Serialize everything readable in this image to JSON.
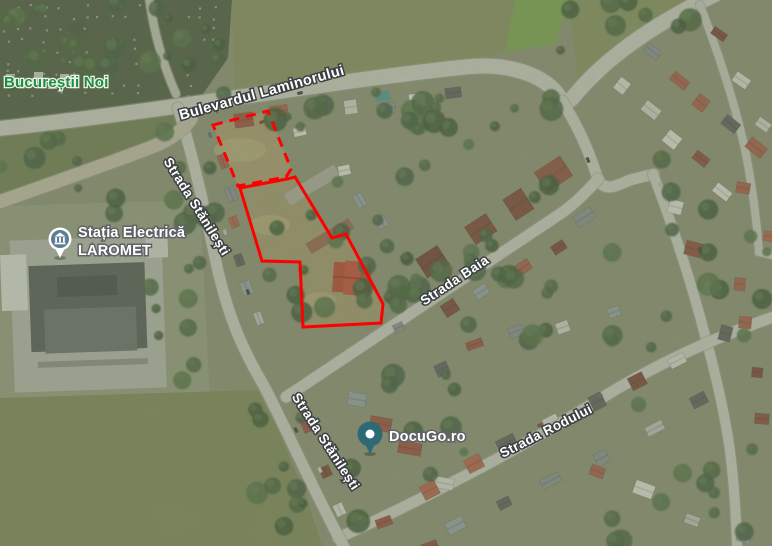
{
  "map": {
    "view_type": "satellite",
    "district_label": {
      "text": "Bucureștii Noi",
      "color": "#1e8e3e"
    },
    "street_labels": [
      {
        "text": "Bulevardul Laminorului",
        "rotation": -15.5
      },
      {
        "text": "Strada Stănilești",
        "rotation": 58
      },
      {
        "text": "Strada Stănilești",
        "rotation": 57
      },
      {
        "text": "Strada Baia",
        "rotation": -33.5
      },
      {
        "text": "Strada Rodului",
        "rotation": -27
      }
    ],
    "pois": [
      {
        "name": "Stația Electrică LAROMET",
        "lines": [
          "Stația Electrică",
          "LAROMET"
        ],
        "icon": "electric-substation-pin",
        "icon_color": "#5b7e96"
      },
      {
        "name": "DocuGo.ro",
        "lines": [
          "DocuGo.ro"
        ],
        "icon": "place-pin",
        "icon_color": "#2d6a75"
      }
    ],
    "parcel_outline": {
      "color": "#ff0000",
      "stroke_width": 3,
      "dash_pattern": "10,7",
      "dashed_polygon": [
        [
          213,
          125
        ],
        [
          268,
          111
        ],
        [
          291,
          169
        ],
        [
          286,
          177
        ],
        [
          238,
          186
        ]
      ],
      "solid_polygon": [
        [
          240,
          188
        ],
        [
          287,
          179
        ],
        [
          295,
          177
        ],
        [
          332,
          238
        ],
        [
          346,
          234
        ],
        [
          383,
          304
        ],
        [
          381,
          323
        ],
        [
          303,
          327
        ],
        [
          300,
          262
        ],
        [
          262,
          261
        ]
      ]
    },
    "roads": [
      {
        "name": "Bulevardul Laminorului",
        "path": "M -6,129 C 160,112 330,81 465,67 C 515,62 548,78 560,98 Q 566,107 575,95 C 609,54 660,21 716,-6",
        "width": 15,
        "color": "#d8d6d1"
      },
      {
        "name": "junction-connector",
        "path": "M 562,101 C 576,123 588,148 597,176 C 603,193 614,187 630,180 L 654,174",
        "width": 11,
        "color": "#d8d6d1"
      },
      {
        "name": "Strada Baia",
        "path": "M 286,397 L 560,214 C 573,205 585,194 598,179",
        "width": 11,
        "color": "#d8d6d1"
      },
      {
        "name": "right-street",
        "path": "M 653,174 C 669,216 689,273 706,339 C 716,376 724,411 729,444 C 734,479 736,513 737,549",
        "width": 10,
        "color": "#d8d6d1"
      },
      {
        "name": "Strada Rodului",
        "path": "M 338,538 C 420,501 520,449 600,399 C 660,362 716,337 776,316",
        "width": 11,
        "color": "#d8d6d1"
      },
      {
        "name": "Strada Stănilești",
        "path": "M 178,108 C 192,152 204,206 216,262 C 228,318 244,352 264,386 C 288,432 316,496 345,549",
        "width": 11,
        "color": "#d8d6d1"
      },
      {
        "name": "cemetery-path",
        "path": "M 149,-4 C 153,28 161,60 176,94",
        "width": 8,
        "color": "#c9c9be"
      },
      {
        "name": "laromet-access-road",
        "path": "M -4,203 C 50,184 110,163 152,147 C 170,140 182,131 191,119",
        "width": 13,
        "color": "#cdc6b2"
      },
      {
        "name": "northeast-lane",
        "path": "M 700,5 C 718,52 738,110 748,165 C 754,198 757,225 759,252 L 776,256",
        "width": 8,
        "color": "#d3d1ca"
      }
    ]
  }
}
